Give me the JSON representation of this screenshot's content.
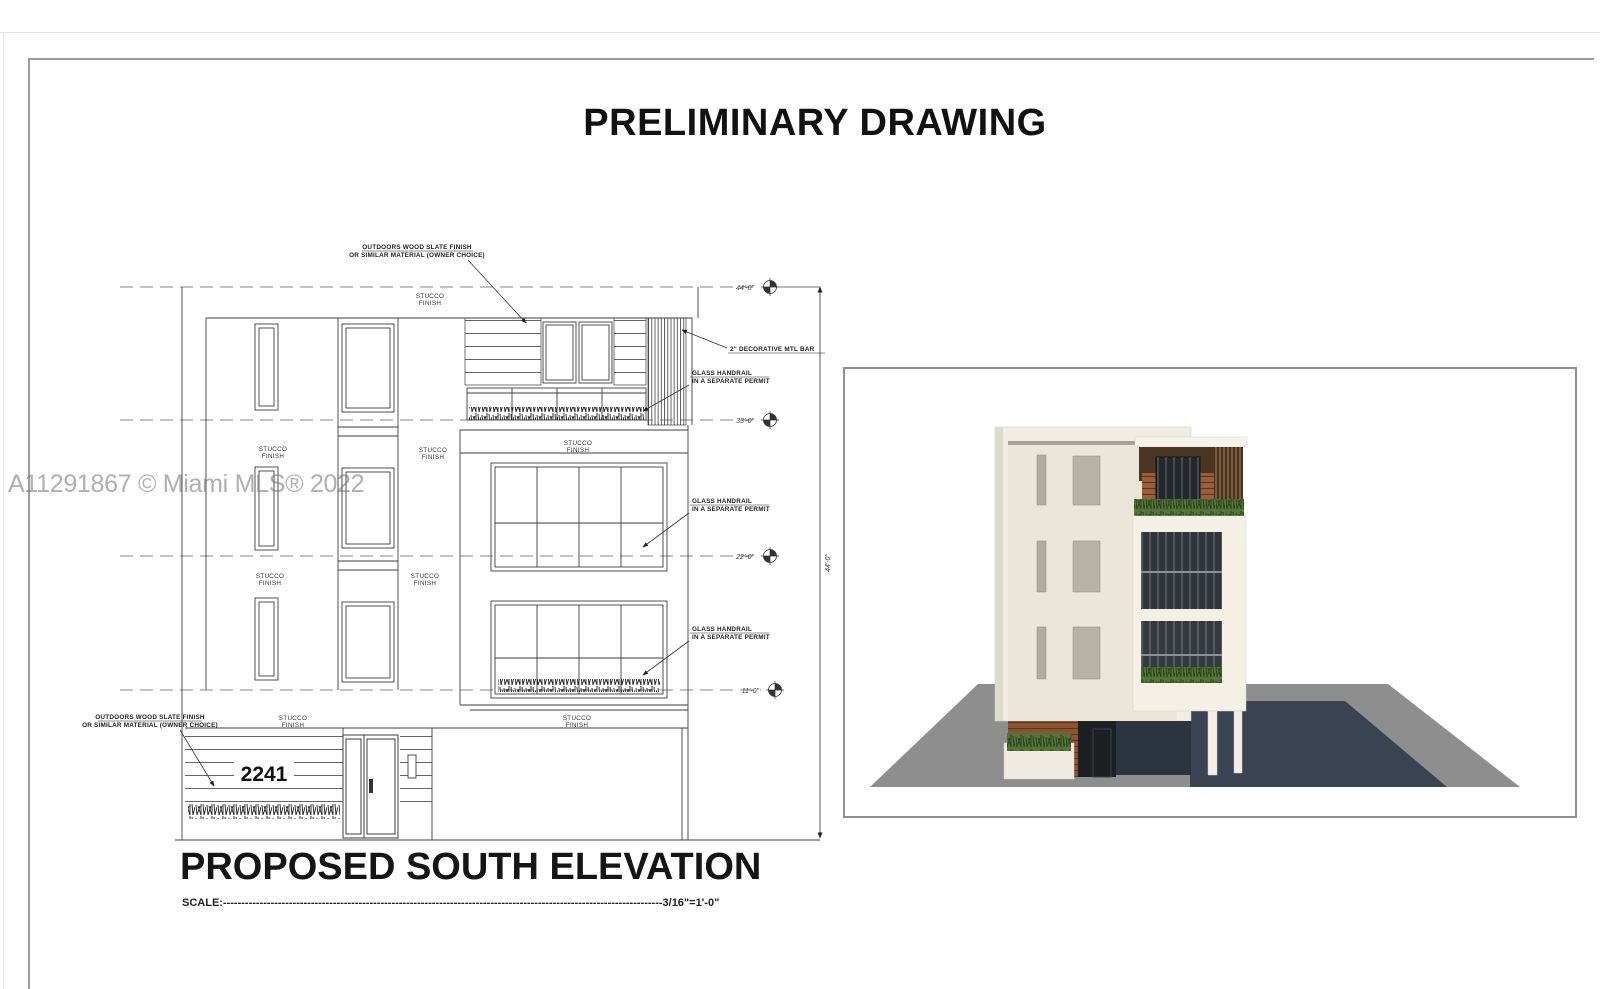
{
  "page": {
    "title": "PRELIMINARY DRAWING",
    "watermark": "A11291867 © Miami MLS® 2022"
  },
  "elevation": {
    "name": "PROPOSED SOUTH ELEVATION",
    "scale_text": "SCALE:------------------------------------------------------------------------------------------------------------------------3/16\"=1'-0\"",
    "house_number": "2241",
    "labels": {
      "stucco_1": "STUCCO",
      "stucco_2": "FINISH"
    },
    "annotations": {
      "wood_slate_1": "OUTDOORS WOOD SLATE FINISH",
      "wood_slate_2": "OR SIMILAR MATERIAL (OWNER CHOICE)",
      "mtl_bar": "2\" DECORATIVE MTL BAR",
      "handrail_1": "GLASS HANDRAIL",
      "handrail_2": "IN A SEPARATE PERMIT"
    },
    "dimensions": {
      "level_44": "44'-0\"",
      "level_33": "33'-0\"",
      "level_22": "22'-0\"",
      "level_11": "11'-0\"",
      "overall_height": "44'-0\""
    }
  }
}
